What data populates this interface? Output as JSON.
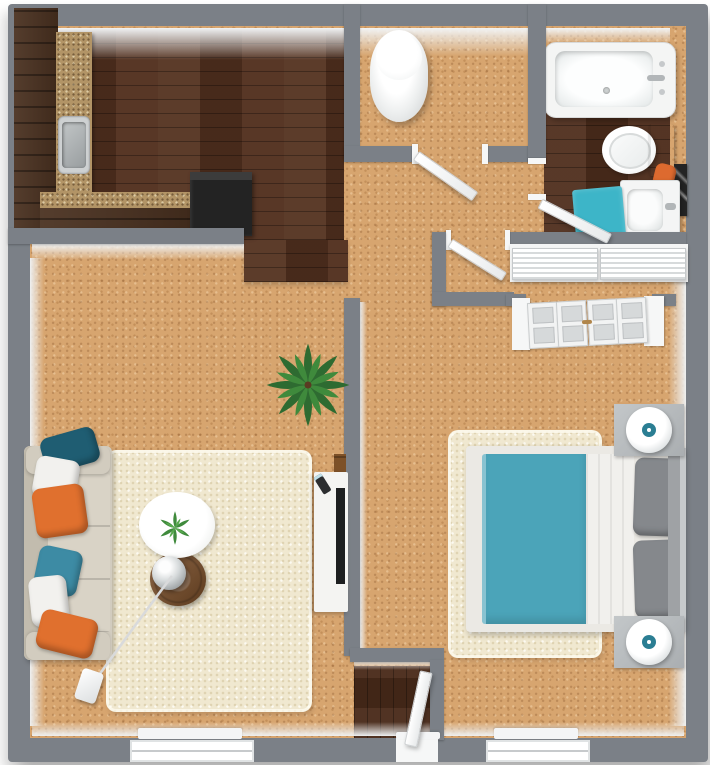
{
  "scene": {
    "type": "3d-floorplan-top-view",
    "description": "One-bedroom apartment 3D floor plan, top-down render, no text labels"
  },
  "palette": {
    "wall": "#7b8087",
    "wall_face": "#eceef0",
    "carpet": "#d7a56f",
    "kitchen_wood": "#53311f",
    "bath_wood": "#4f2e1d",
    "entry_wood": "#4a2b1a",
    "cabinet_wood": "#4a3120",
    "granite": "#b29466",
    "rug_cream": "#f0e8d0",
    "sofa": "#d2ccbf",
    "pillow_dark_teal": "#1f5d72",
    "pillow_teal": "#3d8ba4",
    "pillow_orange": "#e0702e",
    "pillow_white": "#f2f1ee",
    "bed_duvet_teal": "#4ba4b9",
    "bed_sheet": "#f1f0ed",
    "bed_pillow_gray": "#85888c",
    "bath_mat_teal": "#3db5c8",
    "towel_orange": "#dd6a2f",
    "appliance_black": "#232323",
    "side_table_wood": "#7b4e28",
    "door_white": "#f6f7f7",
    "lamp_accent_teal": "#2b7e93",
    "plant_green": "#2e6b31"
  },
  "rooms": [
    {
      "id": "kitchen",
      "floor": "dark-hardwood"
    },
    {
      "id": "living-room",
      "floor": "tan-carpet"
    },
    {
      "id": "bedroom",
      "floor": "tan-carpet"
    },
    {
      "id": "bathroom",
      "floor": "dark-hardwood"
    },
    {
      "id": "utility-closet",
      "floor": "tan-carpet"
    },
    {
      "id": "hallway",
      "floor": "tan-carpet"
    },
    {
      "id": "entry",
      "floor": "dark-hardwood"
    }
  ],
  "furniture": [
    "kitchen-cabinets",
    "kitchen-sink",
    "refrigerator",
    "water-heater",
    "bathtub",
    "toilet",
    "vanity-sink",
    "bath-mat",
    "towel",
    "mirror-panel",
    "louvered-closet",
    "bifold-closet",
    "bed",
    "bed-rug",
    "nightstand-top",
    "nightstand-bottom",
    "lamp-top",
    "lamp-bottom",
    "sofa",
    "throw-pillows",
    "area-rug",
    "coffee-table",
    "side-table",
    "sphere-lamp",
    "arc-lamp-base",
    "floor-plant",
    "table-plant",
    "tv-console",
    "tv",
    "front-door"
  ]
}
